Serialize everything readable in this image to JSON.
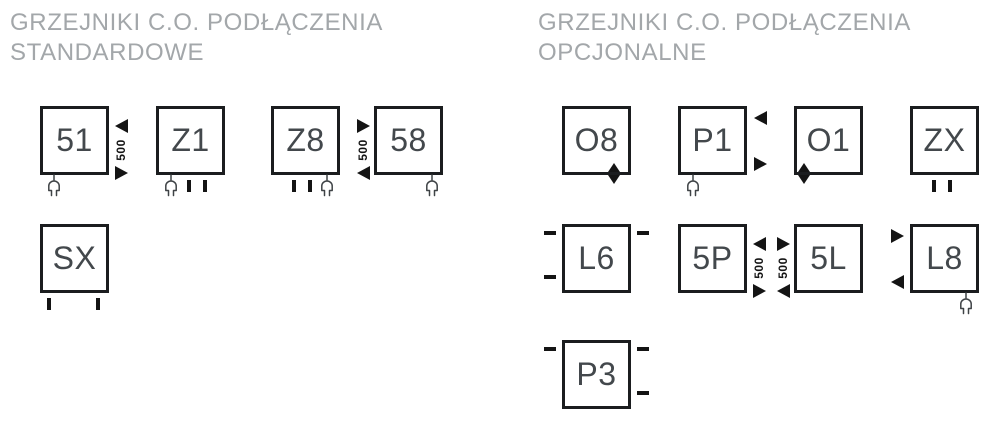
{
  "titles": {
    "standard": {
      "line1": "GRZEJNIKI C.O. PODŁĄCZENIA",
      "line2": "STANDARDOWE"
    },
    "optional": {
      "line1": "GRZEJNIKI C.O. PODŁĄCZENIA",
      "line2": "OPCJONALNE"
    }
  },
  "dimension": {
    "value": "500"
  },
  "boxes": {
    "51": {
      "label": "51"
    },
    "Z1": {
      "label": "Z1"
    },
    "Z8": {
      "label": "Z8"
    },
    "58": {
      "label": "58"
    },
    "SX": {
      "label": "SX"
    },
    "O8": {
      "label": "O8"
    },
    "P1": {
      "label": "P1"
    },
    "O1": {
      "label": "O1"
    },
    "ZX": {
      "label": "ZX"
    },
    "L6": {
      "label": "L6"
    },
    "5P": {
      "label": "5P"
    },
    "5L": {
      "label": "5L"
    },
    "L8": {
      "label": "L8"
    },
    "P3": {
      "label": "P3"
    }
  },
  "colors": {
    "bg": "#ffffff",
    "border": "#1b1d1f",
    "label": "#43484c",
    "title": "#a3a7aa",
    "mark": "#141414",
    "plug": "#3f4346"
  }
}
